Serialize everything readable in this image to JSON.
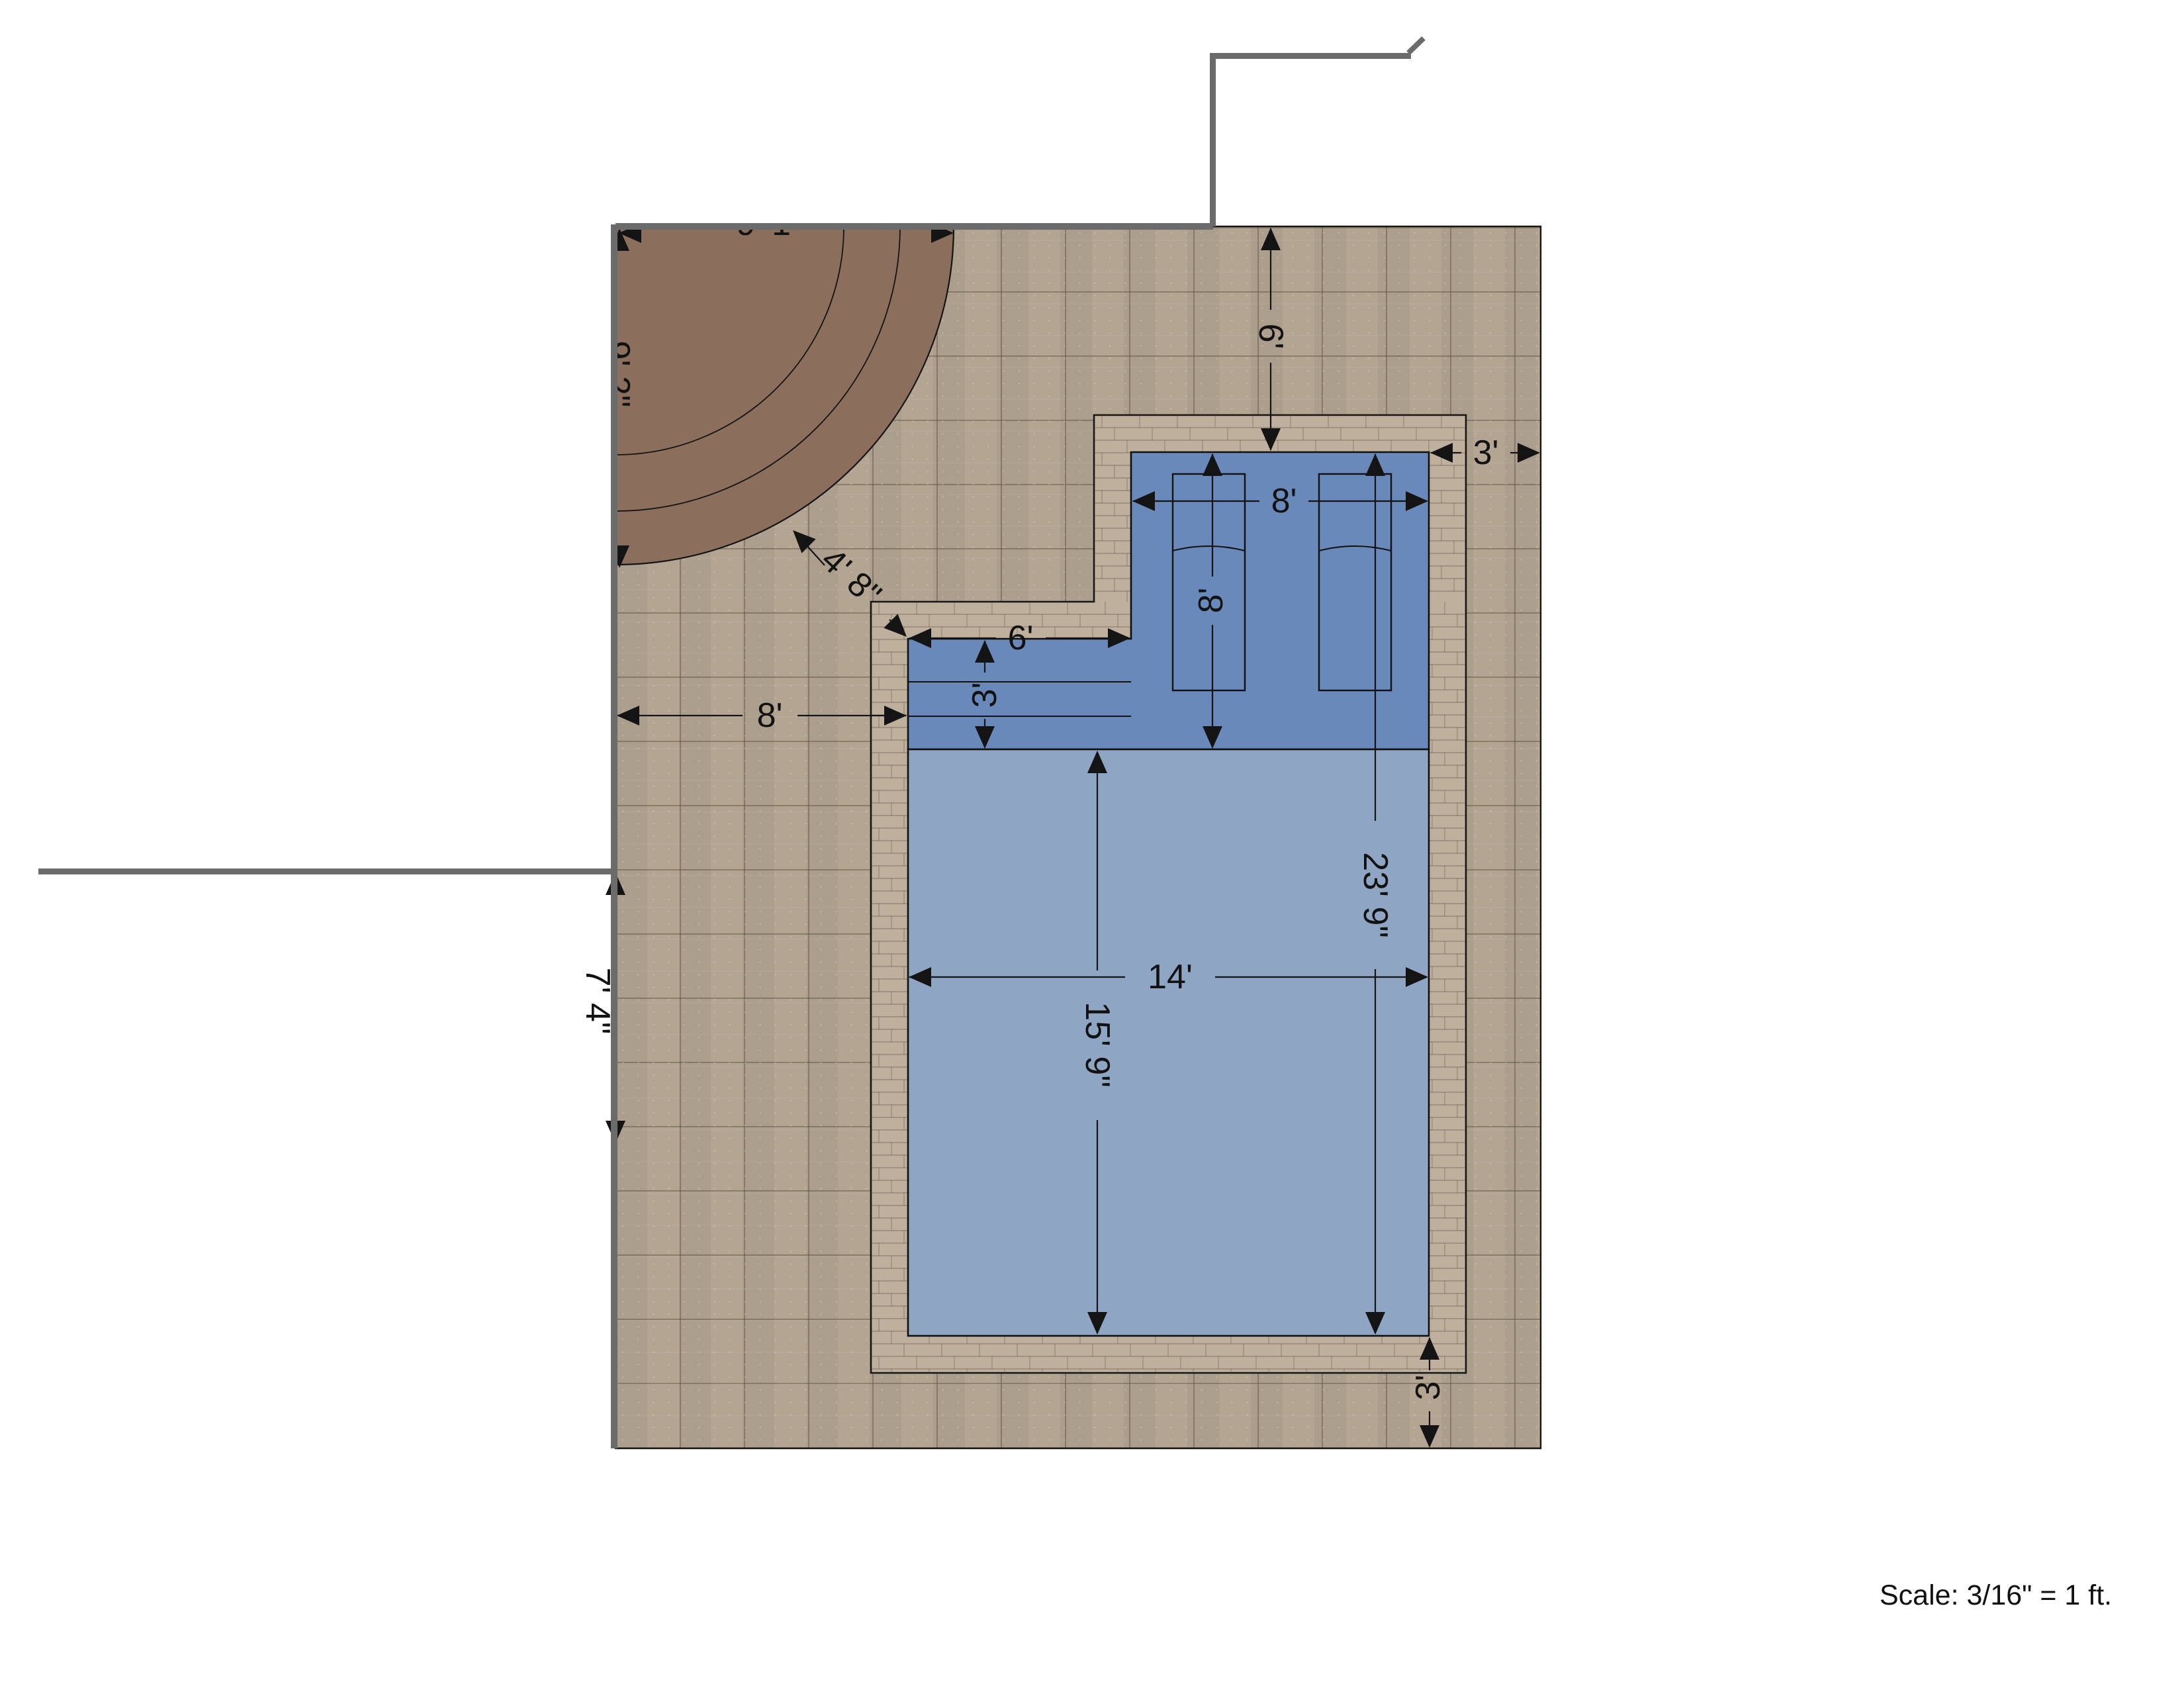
{
  "drawing": {
    "type": "pool-patio-plan",
    "scale_note": "Scale: 3/16\" = 1 ft.",
    "dims": {
      "top_setback": "6'",
      "right_setback": "3'",
      "ledge_width": "8'",
      "ledge_depth": "8'",
      "step_width": "6'",
      "step_depth": "3'",
      "left_walkway": "8'",
      "pool_total_length": "23' 9\"",
      "pool_width": "14'",
      "main_pool_length": "15' 9\"",
      "house_side_gap": "7' 4\"",
      "bottom_setback": "3'",
      "circle_clearance": "4' 8\"",
      "circle_dim_top": "9' 1\"",
      "circle_dim_left": "9' 2\""
    },
    "colors": {
      "patio_paver": "#b4a592",
      "coping": "#bfb09e",
      "pool_shallow_ledge": "#6889b9",
      "pool_main": "#8ea5c4",
      "circle_feature": "#8b6f5c",
      "side_structure": "#8a6c59",
      "wall_line": "#6b6b6b",
      "dimension_ink": "#141414"
    }
  }
}
